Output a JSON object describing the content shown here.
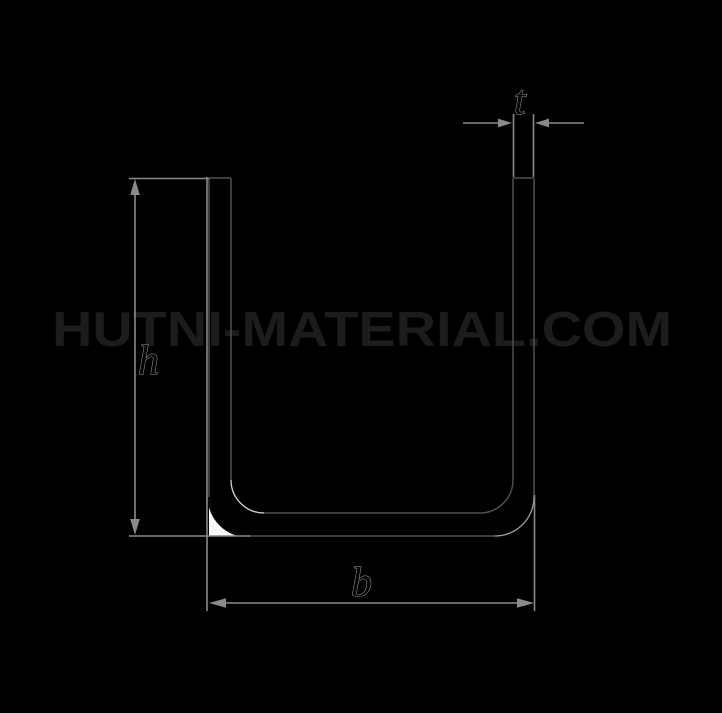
{
  "watermark": {
    "text": "HUTNI-MATERIAL.COM",
    "color": "#1c1c1c"
  },
  "dimensions": {
    "thickness_label": "t",
    "height_label": "h",
    "width_label": "b"
  },
  "colors": {
    "background": "#000000",
    "dimension_lines": "#8a8a8a",
    "profile_outline": "#4f4f4f",
    "corner_fill": "#f8f8f8",
    "corner_arc": "#0a0a0a",
    "highlight_arc_bright": "#d2d2d2",
    "highlight_arc_dim": "#a0a0a0",
    "label_fill": "#060606",
    "label_stroke": "#9c9c9c"
  }
}
